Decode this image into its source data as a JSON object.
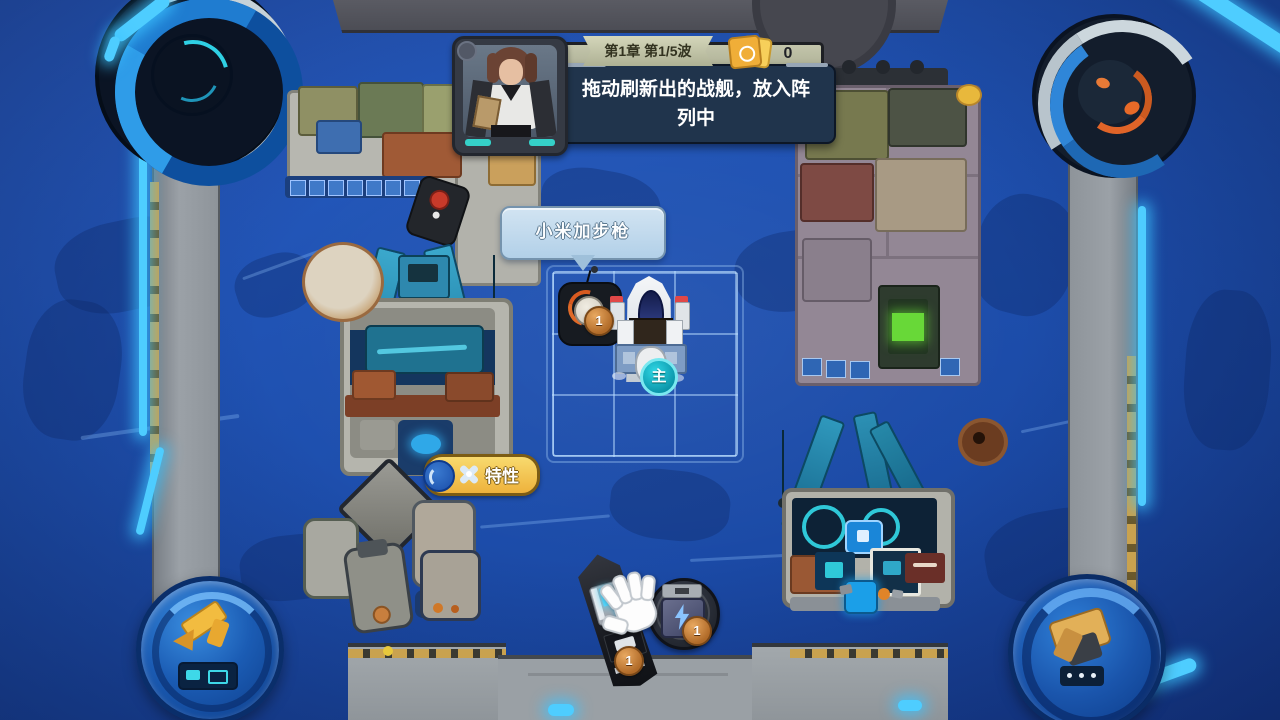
{
  "hud": {
    "unit_capacity": "15",
    "wave_banner": "第1章 第1/5波",
    "card_count": "0",
    "dialogue": "拖动刷新出的战舰，放入阵列中"
  },
  "tooltip": {
    "text": "小米加步枪"
  },
  "trait": {
    "label": "特性"
  },
  "board": {
    "grid": {
      "rows": 3,
      "cols": 3
    },
    "units": [
      {
        "name": "turret",
        "cell": "top-left",
        "level": "1"
      },
      {
        "name": "main-ship",
        "cell": "middle-column",
        "badge": "主"
      }
    ]
  },
  "shop": {
    "items": [
      {
        "name": "gunboat",
        "level": "1"
      },
      {
        "name": "energy-module",
        "level": "1",
        "icon": "lightning-icon"
      }
    ]
  },
  "icons": {
    "trait": "cross-icon",
    "resource_card": "card-icon",
    "cursor": "hand-cursor",
    "corner_bl": "crane-emblem",
    "corner_br": "anchor-emblem"
  },
  "colors": {
    "water": "#1d4dab",
    "glow": "#4ecdff",
    "gold": "#f0b43c",
    "main_badge_teal": "#10b4c8",
    "level_badge_bronze": "#c98a4e"
  }
}
